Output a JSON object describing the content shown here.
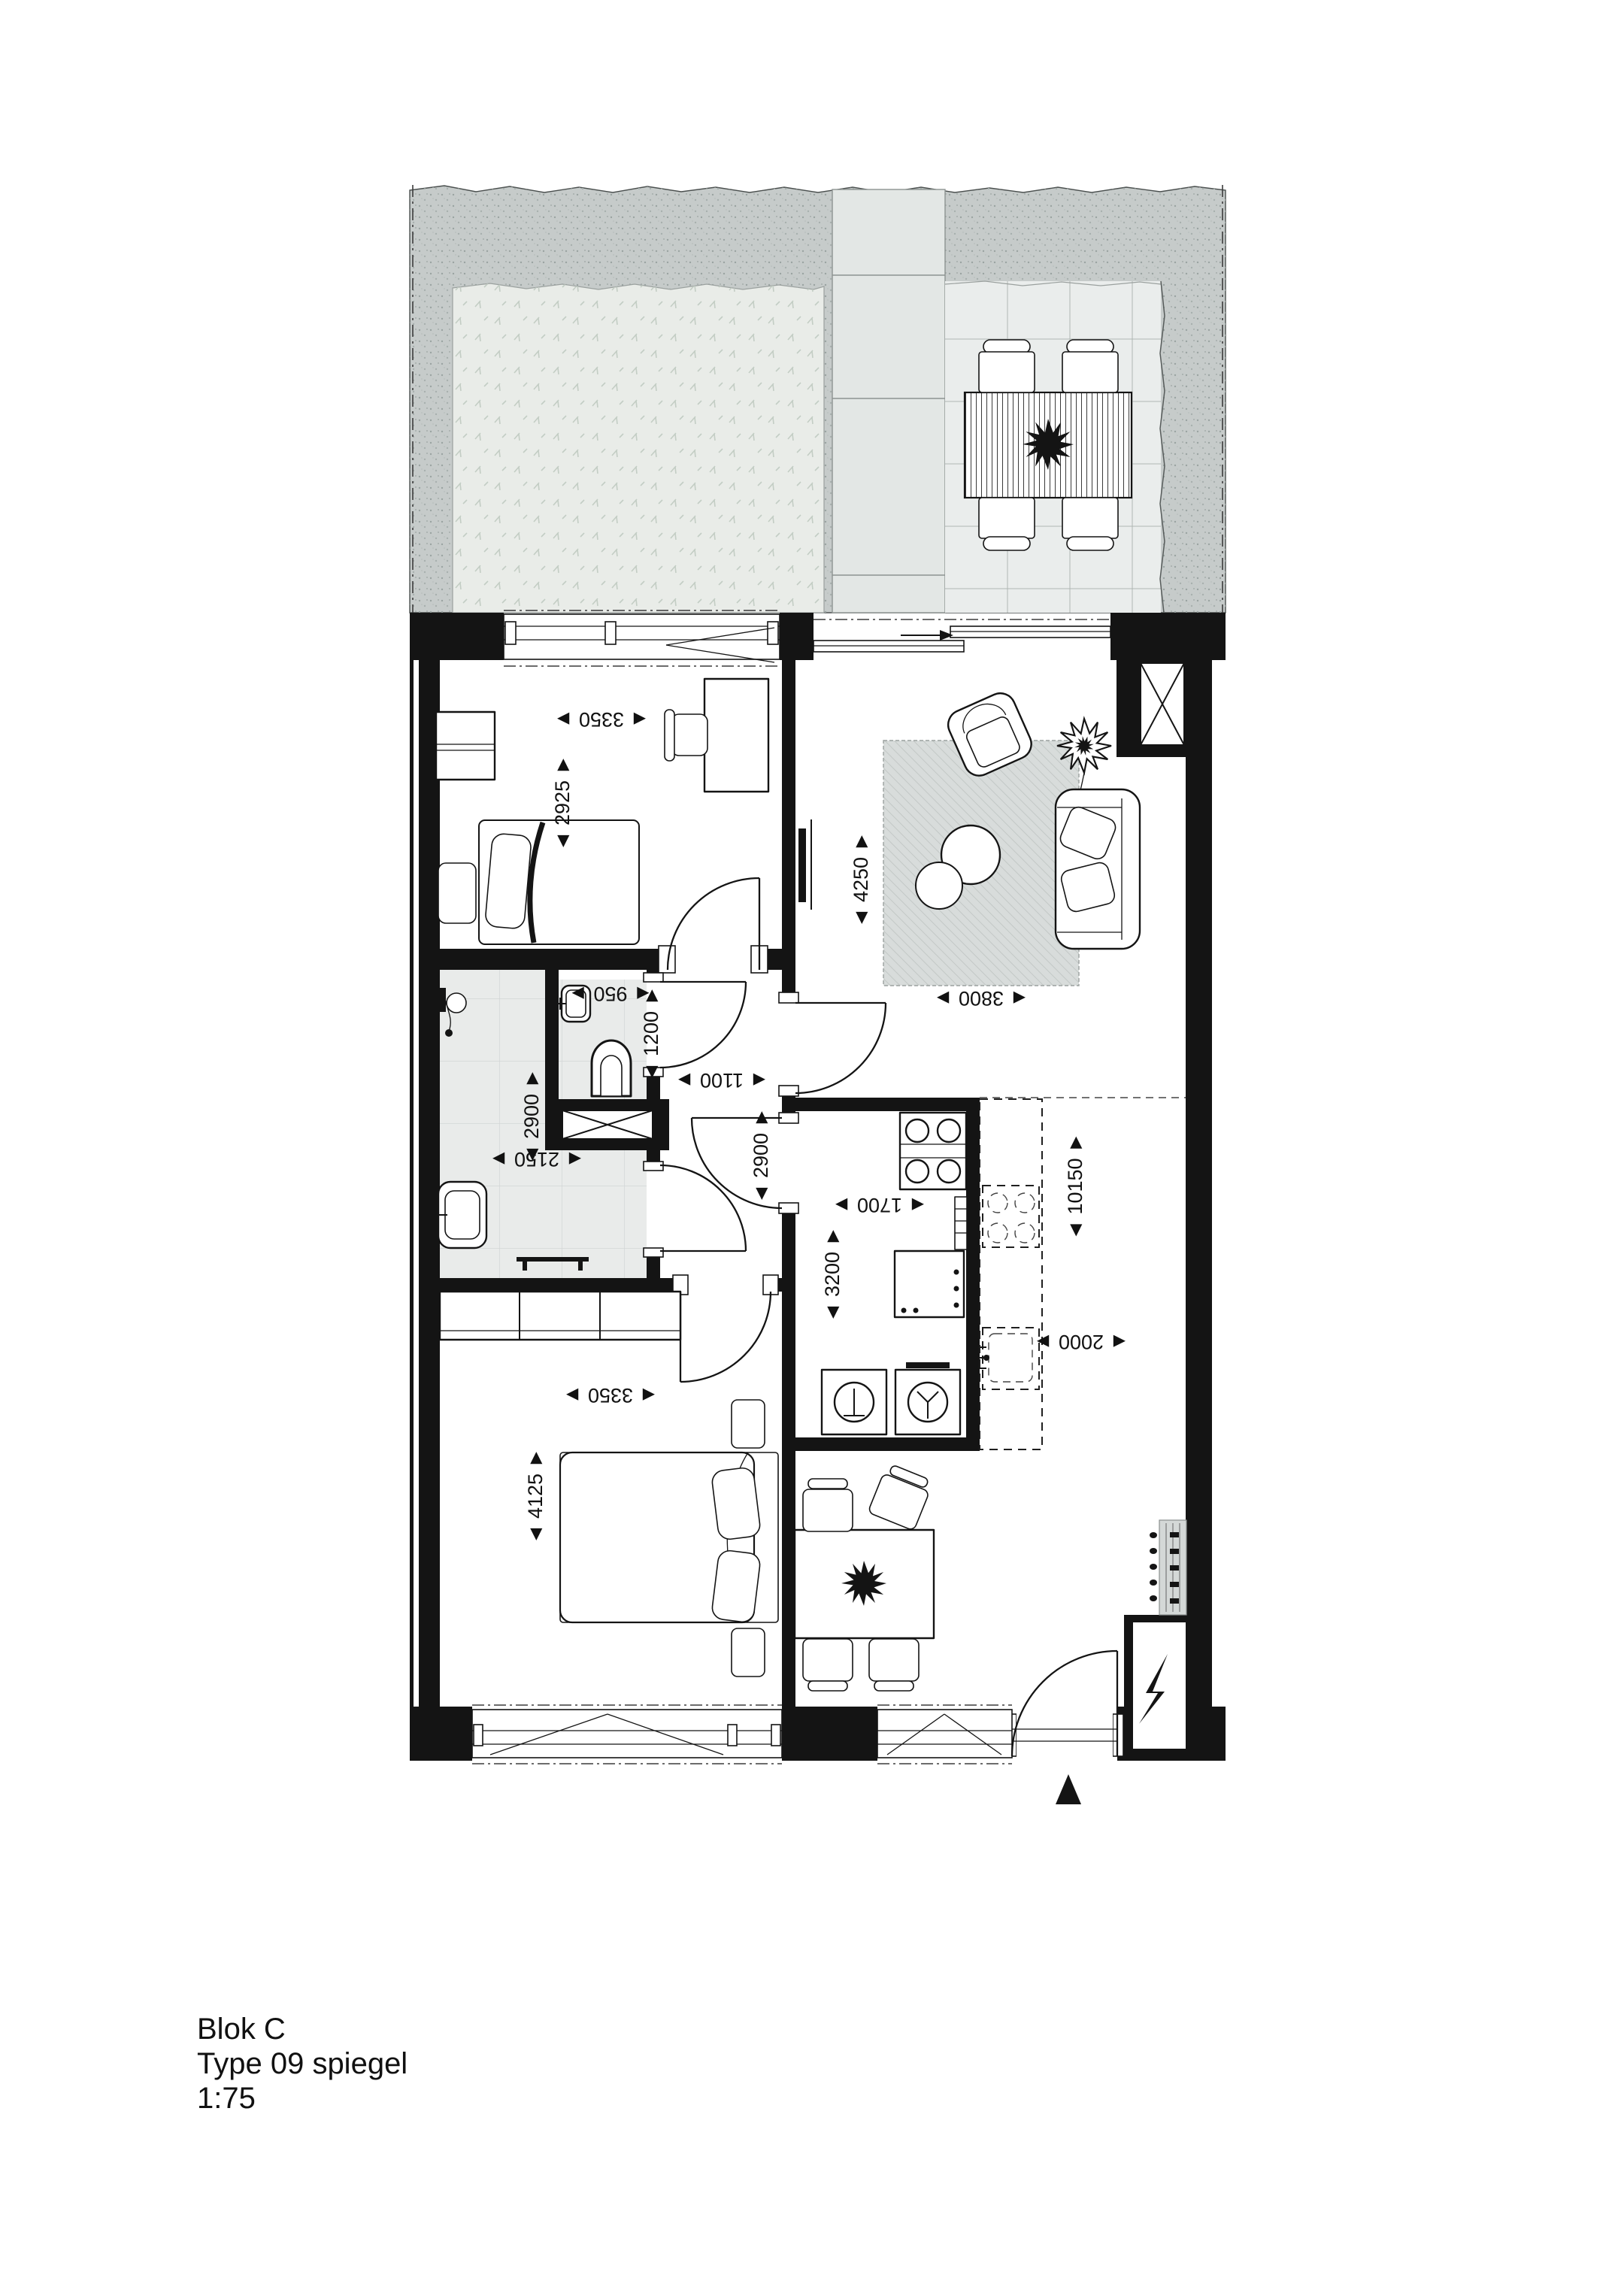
{
  "title_block": {
    "project": "Blok C",
    "unit_type": "Type 09 spiegel",
    "scale": "1:75"
  },
  "dims": [
    {
      "id": "bedroom1-width",
      "value": "3350",
      "text": "◄ 3350 ►"
    },
    {
      "id": "bedroom1-depth",
      "value": "2925",
      "text": "◄ 2925 ►"
    },
    {
      "id": "wc-width",
      "value": "950",
      "text": "◄ 950 ►"
    },
    {
      "id": "wc-depth",
      "value": "1200",
      "text": "◄ 1200 ►"
    },
    {
      "id": "hall-width",
      "value": "1100",
      "text": "◄ 1100 ►"
    },
    {
      "id": "bathroom-depth",
      "value": "2900",
      "text": "◄ 2900 ►"
    },
    {
      "id": "bathroom-width",
      "value": "2150",
      "text": "◄ 2150 ►"
    },
    {
      "id": "hall-depth",
      "value": "2900",
      "text": "◄ 2900 ►"
    },
    {
      "id": "living-depth",
      "value": "4250",
      "text": "◄ 4250 ►"
    },
    {
      "id": "living-width",
      "value": "3800",
      "text": "◄ 3800 ►"
    },
    {
      "id": "utility-width",
      "value": "1700",
      "text": "◄ 1700 ►"
    },
    {
      "id": "utility-depth",
      "value": "3200",
      "text": "◄ 3200 ►"
    },
    {
      "id": "total-depth",
      "value": "10150",
      "text": "◄ 10150 ►"
    },
    {
      "id": "dining-width",
      "value": "2000",
      "text": "◄ 2000 ►"
    },
    {
      "id": "bedroom2-width",
      "value": "3350",
      "text": "◄ 3350 ►"
    },
    {
      "id": "bedroom2-depth",
      "value": "4125",
      "text": "◄ 4125 ►"
    }
  ],
  "markers": {
    "entrance_direction": "filled-triangle-up",
    "electrical_cabinet": "lightning-bolt",
    "shafts": "crossed-box",
    "optional_kitchen": "dashed-outline"
  },
  "colors": {
    "walls": "#141414",
    "gravel": "#c6cbca",
    "grass": "#e9ece8",
    "pavement": "#e3e7e5",
    "patio_tiles": "#eaedec",
    "bath_tiles": "#e9ebea",
    "rug": "#d8dcdb",
    "paper": "#ffffff"
  }
}
